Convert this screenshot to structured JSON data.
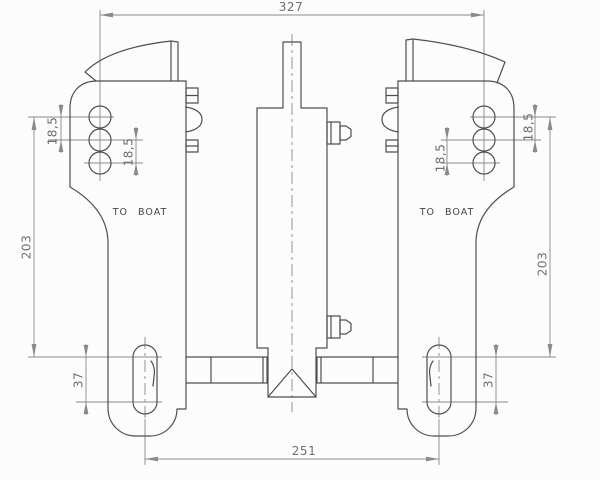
{
  "drawing": {
    "labels": {
      "to_boat_left": "TO BOAT",
      "to_boat_right": "TO BOAT"
    },
    "dimensions": {
      "overall_width": "327",
      "lower_span": "251",
      "height_left": "203",
      "height_right": "203",
      "hole_pitch_left_outer": "18,5",
      "hole_pitch_left_inner": "18,5",
      "hole_pitch_right_outer": "18,5",
      "hole_pitch_right_inner": "18,5",
      "slot_pitch_left": "37",
      "slot_pitch_right": "37"
    },
    "colors": {
      "background": "#fcfcfc",
      "part_line": "#4f4f4f",
      "dimension_line": "#8a8a8a",
      "dimension_text": "#6e6e6e",
      "label_text": "#454545"
    }
  }
}
